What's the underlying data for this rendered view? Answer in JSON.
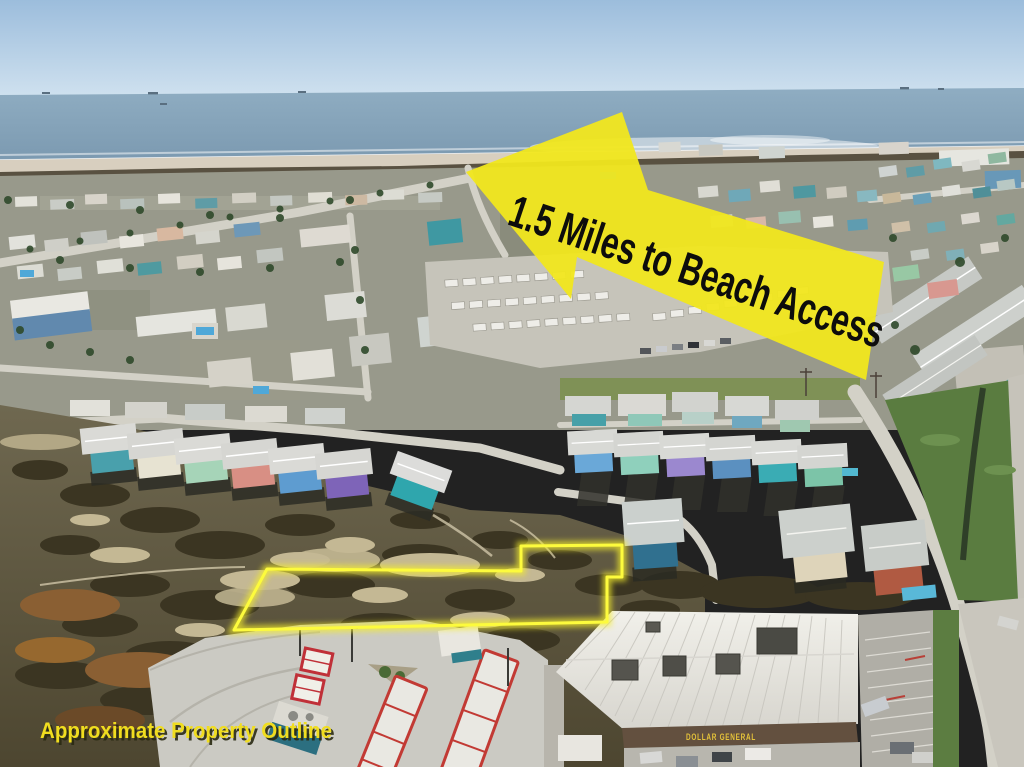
{
  "annotations": {
    "arrow_label": "1.5 Miles to Beach Access",
    "arrow_fill": "#f1e71e",
    "arrow_text_color": "#0d0d0c",
    "outline_caption": "Approximate Property Outline",
    "caption_color": "#f0dd1f",
    "outline_color": "#fdfb3d"
  },
  "buildings": {
    "store_sign": "DOLLAR GENERAL",
    "store_sign_color": "#e5c33a"
  }
}
